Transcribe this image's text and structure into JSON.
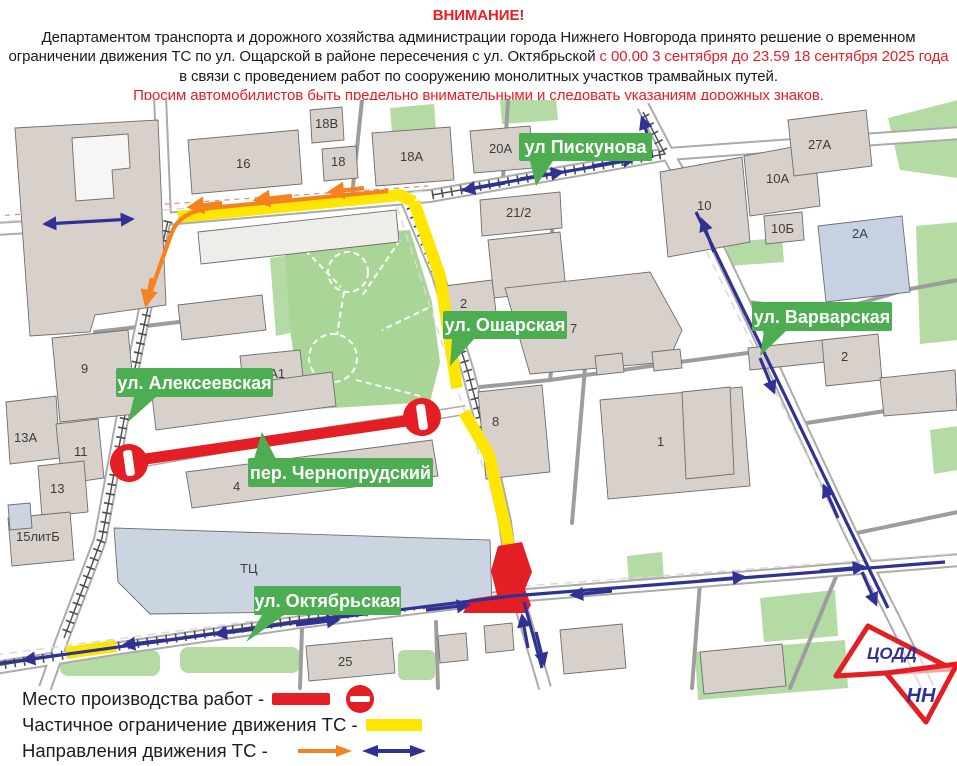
{
  "header": {
    "title": "ВНИМАНИЕ!",
    "p1_black": "Департаментом транспорта и дорожного хозяйства администрации города Нижнего Новгорода принято решение о временном ограничении движения ТС по ул. Ощарской в районе пересечения с ул. Октябрьской",
    "p1_red": " с 00.00 3 сентября до 23.59 18 сентября 2025 года",
    "p1_black2": " в связи с проведением работ по сооружению монолитных участков трамвайных путей.",
    "p2_red": "Просим автомобилистов быть предельно внимательными и следовать указаниям дорожных знаков."
  },
  "map": {
    "streets": [
      "ул Пискунова",
      "ул. Ошарская",
      "ул. Варварская",
      "ул. Алексеевская",
      "пер. Чернопрудский",
      "ул. Октябрьская"
    ],
    "buildings": [
      "16",
      "18В",
      "18",
      "18А",
      "20А",
      "21/2",
      "10",
      "10А",
      "10Б",
      "27А",
      "2А",
      "2",
      "2",
      "7",
      "9",
      "8А1",
      "13А",
      "11",
      "13",
      "15литБ",
      "4",
      "8",
      "1",
      "ТЦ",
      "25"
    ]
  },
  "legend": {
    "items": [
      {
        "label": "Место производства работ -",
        "key": "work-site"
      },
      {
        "label": "Частичное ограничение движения ТС -",
        "key": "partial-restriction"
      },
      {
        "label": "Направления движения ТС -",
        "key": "traffic-directions"
      }
    ]
  },
  "logo": {
    "line1": "ЦОДД",
    "line2": "НН"
  },
  "colors": {
    "closure_red": "#e31e24",
    "restriction_yellow": "#ffe600",
    "direction_blue": "#2f3293",
    "direction_orange": "#f58220",
    "street_label_green": "#4cae50",
    "header_red": "#ec1c24"
  }
}
